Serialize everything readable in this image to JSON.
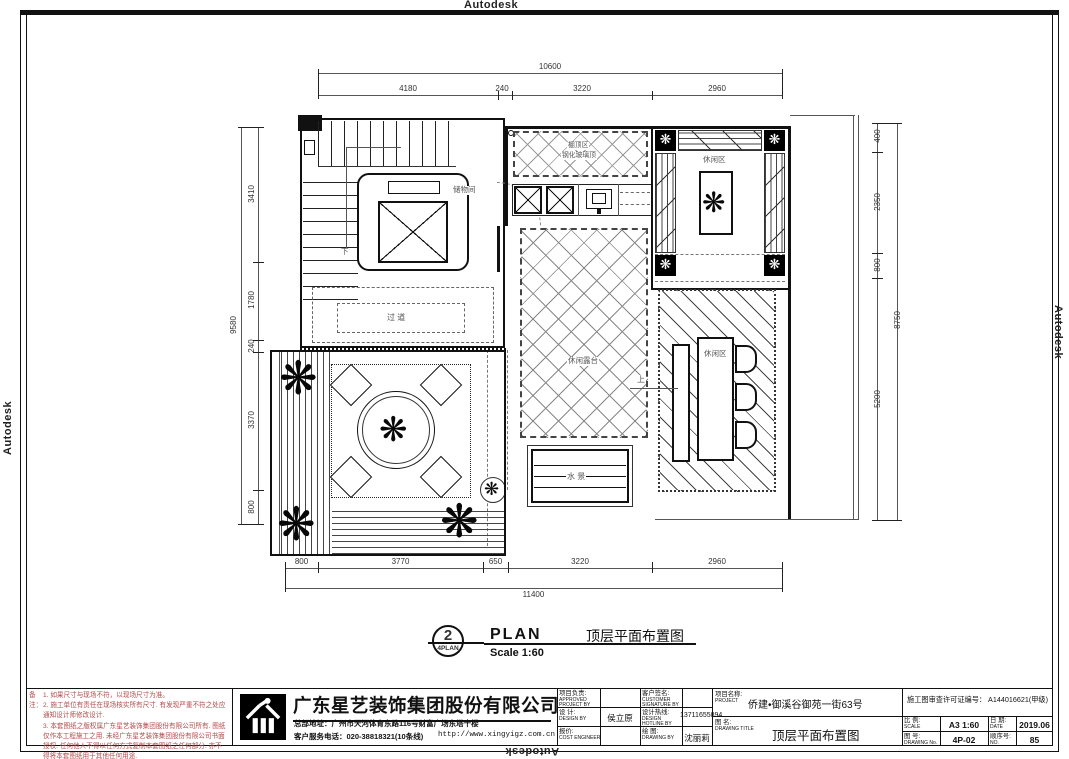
{
  "watermark": "Autodesk",
  "glyphs": {
    "plant": "❋"
  },
  "notes": {
    "label": "备注：",
    "line1": "1. 如果尺寸与现场不符，以现场尺寸为准。",
    "line2": "2. 施工单位有责任在现场核实所有尺寸. 有发现严重不符之处应通知设计师修改设计.",
    "line3": "3. 本套图纸之版权属广东星艺装饰集团股份有限公司所有. 图纸仅作本工程施工之用. 未经广东星艺装饰集团股份有限公司书面授权. 任何他人不得以任何方式复制本套图纸之任何部分. 亦不得将本套图纸用于其他任何用途.",
    "color": "#b34a4a"
  },
  "company": {
    "name": "广东星艺装饰集团股份有限公司",
    "address": "总部地址：广州市天河体育东路116号财富广场东塔十楼",
    "phone": "客户服务电话：020-38818321(10条线)",
    "website": "http://www.xingyigz.com.cn"
  },
  "titleblock": {
    "approved_label": "项目负责:",
    "approved_en": "APPROVED PROJECT BY",
    "approved_value": "",
    "customer_label": "客户签名:",
    "customer_en": "CUSTOMER SIGNATURE BY",
    "customer_value": "",
    "design_label": "设 计:",
    "design_en": "DESIGN BY",
    "design_value": "侯立原",
    "hotline_label": "设计热线:",
    "hotline_en": "DESIGN HOTLINE BY",
    "hotline_value": "13711655894",
    "cost_label": "报价:",
    "cost_en": "COST ENGINEER",
    "cost_value": "",
    "drawnby_label": "绘 图:",
    "drawnby_en": "DRAWING BY",
    "drawnby_value": "沈丽莉",
    "project_label": "项目名称:",
    "project_en": "PROJECT",
    "project_value": "侨建•御溪谷御苑一街63号",
    "permit": "施工图审查许可证编号： A144016621(甲级)",
    "title_label": "图 名:",
    "title_en": "DRAWING TITLE",
    "title_value": "顶层平面布置图",
    "scale_label": "比 例:",
    "scale_en": "SCALE",
    "scale_value": "A3 1:60",
    "date_label": "日 期:",
    "date_en": "DATE",
    "date_value": "2019.06",
    "no_label": "图 号:",
    "no_en": "DRAWING No.",
    "no_value": "4P-02",
    "seq_label": "顺序号:",
    "seq_en": "NO.",
    "seq_value": "85"
  },
  "plan_marker": {
    "number": "2",
    "sub": "4PLAN",
    "name": "PLAN",
    "scale": "Scale 1:60",
    "title_cn": "顶层平面布置图"
  },
  "rooms": {
    "storage": "储物间",
    "corridor": "过 道",
    "terrace": "休闲露台",
    "leisure_top": "休闲区",
    "leisure_bottom": "休闲区",
    "water": "水 景",
    "down": "下",
    "up": "上",
    "skylight1": "棚顶区",
    "skylight2": "钢化玻璃顶"
  },
  "dims": {
    "top_total": "10600",
    "top_seg1": "4180",
    "top_seg2": "240",
    "top_seg3": "3220",
    "top_seg4": "2960",
    "bottom_total": "11400",
    "bottom_seg1": "800",
    "bottom_seg2": "3770",
    "bottom_seg3": "650",
    "bottom_seg4": "3220",
    "bottom_seg5": "2960",
    "left_total": "9580",
    "left_seg1": "3410",
    "left_seg2": "1780",
    "left_seg3": "240",
    "left_seg4": "3370",
    "left_seg5": "800",
    "right_total": "8750",
    "right_seg1": "400",
    "right_seg2": "2350",
    "right_seg3": "800",
    "right_seg4": "5200"
  }
}
